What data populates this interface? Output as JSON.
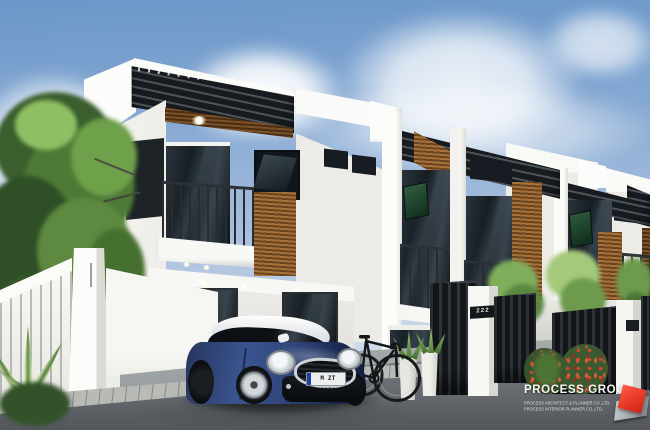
{
  "watermark": {
    "company": "PROCESS GROUP",
    "line1": "PROCESS ARCHITECT & PLANNER CO.,LTD.",
    "line2": "PROCESS INTERIOR PLANNER CO.,LTD."
  },
  "car": {
    "license_plate": "M ZT 4350"
  },
  "gate": {
    "house_number": "222"
  },
  "palette": {
    "sky_top": "#6b97c9",
    "sky_horizon": "#dde5f0",
    "facade_white": "#f5f4f0",
    "facade_shadow": "#e6e5e0",
    "canopy_dark": "#171b1f",
    "wood_brown": "#8a5a30",
    "glass_dark": "#141a1f",
    "railing_dark": "#2a2f34",
    "car_blue": "#31477d",
    "car_roof_white": "#eef0f2",
    "ground_asphalt": "#5f6367",
    "paver_light": "#b7bab5",
    "foliage_green": "#5d8a42",
    "flower_red": "#c4392b",
    "logo_red": "#d21f12",
    "indicator_green": "#41e063"
  }
}
